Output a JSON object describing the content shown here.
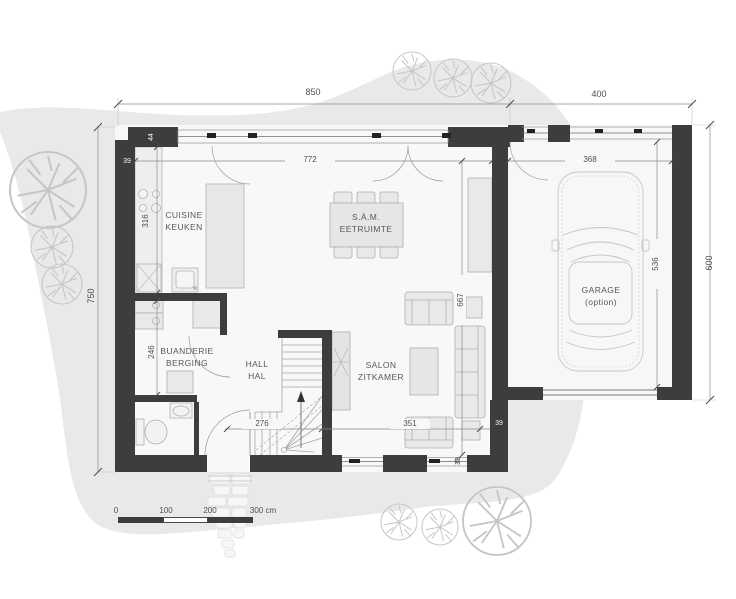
{
  "plan": {
    "type": "ground-floor architectural plan",
    "colors": {
      "wall": "#3d3d3d",
      "garden": "#e9e9e9",
      "floor": "#f8f8f7",
      "furniture_fill": "#e9e9e8",
      "furniture_stroke": "#adadad",
      "dimension_line": "#8a8a8a",
      "text": "#4f4f4f",
      "text_on_wall": "#f3f3f3"
    }
  },
  "rooms": {
    "kitchen": {
      "line1": "CUISINE",
      "line2": "KEUKEN"
    },
    "dining": {
      "line1": "S.À.M.",
      "line2": "EETRUIMTE"
    },
    "laundry": {
      "line1": "BUANDERIE",
      "line2": "BERGING"
    },
    "hall": {
      "line1": "HALL",
      "line2": "HAL"
    },
    "living": {
      "line1": "SALON",
      "line2": "ZITKAMER"
    },
    "garage": {
      "line1": "GARAGE",
      "line2": "(option)"
    }
  },
  "dims": {
    "top_main": "850",
    "top_garage": "400",
    "left": "750",
    "right": "600",
    "living_window": "772",
    "garage_window": "368",
    "kitchen": "316",
    "corner": "44",
    "wall_left": "39",
    "laundry": "246",
    "hall": "276",
    "salon": "351",
    "living_depth": "667",
    "garage_depth": "536",
    "wall_right": "39",
    "wall_bottom": "39"
  },
  "scale_bar": {
    "labels": [
      "0",
      "100",
      "200",
      "300 cm"
    ]
  }
}
